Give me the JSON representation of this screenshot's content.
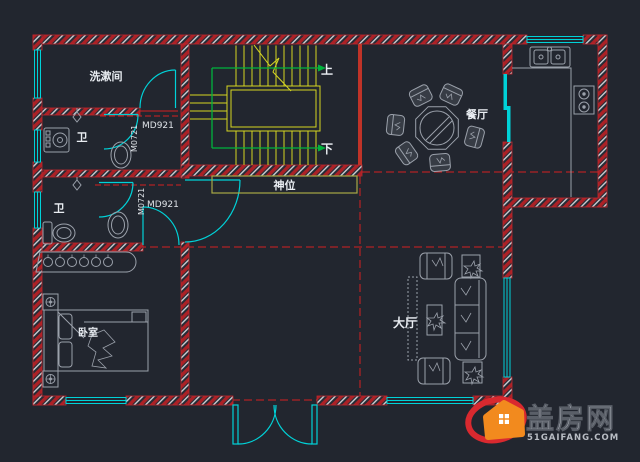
{
  "canvas": {
    "width": 640,
    "height": 462,
    "background": "#22262f"
  },
  "colors": {
    "wall_red": "#ab2126",
    "wall_edge": "#c3272e",
    "window_cyan": "#00d2d8",
    "stair_yellow": "#d6d622",
    "route_green": "#00b33c",
    "centerline_red": "#d42020",
    "furniture_gray": "#9ba1ab",
    "shrine_olive": "#a8a845",
    "label_white": "#e9edf2",
    "logo_orange": "#f28a1e",
    "logo_red": "#d9292f"
  },
  "rooms": {
    "washroom": "洗漱间",
    "toilet_upper": "卫",
    "toilet_lower": "卫",
    "dining": "餐厅",
    "hall": "大厅",
    "bedroom": "卧室",
    "shrine": "神位"
  },
  "stairs": {
    "up": "上",
    "down": "下"
  },
  "door_tags": {
    "upper_md": "MD921",
    "upper_m": "M0721",
    "lower_md": "MD921",
    "lower_m": "M0721"
  },
  "logo": {
    "title": "盖房网",
    "domain": "51GAIFANG.COM"
  }
}
